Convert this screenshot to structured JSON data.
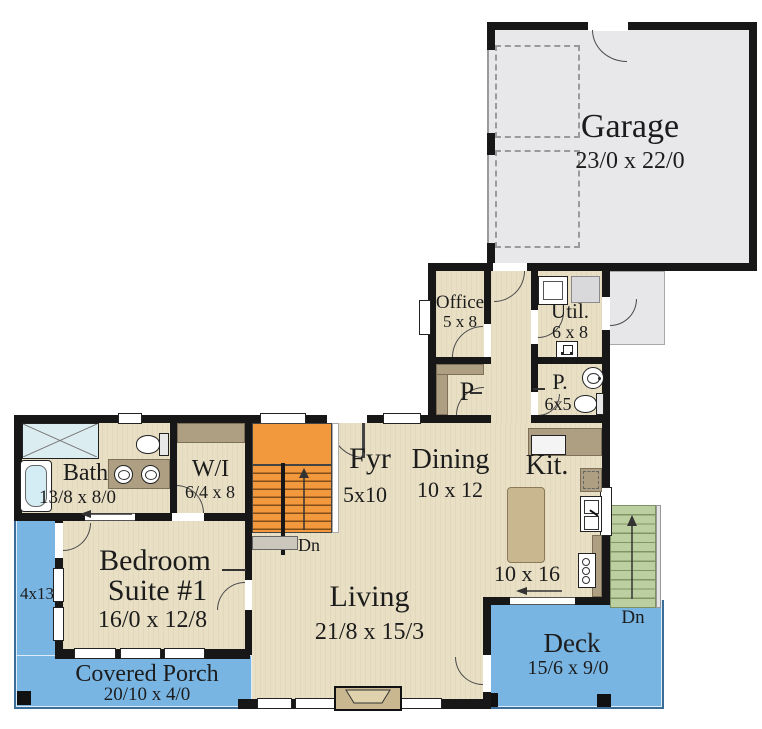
{
  "rooms": {
    "garage": {
      "name": "Garage",
      "dims": "23/0 x 22/0"
    },
    "office": {
      "name": "Office",
      "dims": "5 x 8"
    },
    "utility": {
      "name": "Util.",
      "dims": "6 x 8"
    },
    "pantry": {
      "name": "P"
    },
    "powder": {
      "name": "P.",
      "dims": "6x5"
    },
    "bath": {
      "name": "Bath",
      "dims": "13/8 x 8/0"
    },
    "walkin": {
      "name": "W/I",
      "dims": "6/4 x 8"
    },
    "foyer": {
      "name": "Fyr",
      "dims": "5x10"
    },
    "dining": {
      "name": "Dining",
      "dims": "10 x 12"
    },
    "kitchen": {
      "name": "Kit.",
      "dims": "10 x 16"
    },
    "living": {
      "name": "Living",
      "dims": "21/8 x 15/3"
    },
    "bedroom": {
      "name_line1": "Bedroom",
      "name_line2": "Suite #1",
      "dims": "16/0 x 12/8"
    },
    "covered_porch": {
      "name": "Covered Porch",
      "dims": "20/10 x 4/0"
    },
    "side_porch": {
      "dims": "4x13"
    },
    "deck": {
      "name": "Deck",
      "dims": "15/6 x 9/0"
    }
  },
  "stairs": {
    "foyer": {
      "label": "Dn"
    },
    "deck": {
      "label": "Dn"
    }
  },
  "colors": {
    "wall": "#171717",
    "floor_beige": "#e8dfc5",
    "garage_gray": "#e8e8ea",
    "stair_orange": "#f2993e",
    "deck_stair_green": "#bccfa1",
    "porch_blue": "#79b5e3",
    "counter_tan": "#ae9f82",
    "island_tan": "#c9b88f",
    "shower_blue": "#dcedf2"
  }
}
